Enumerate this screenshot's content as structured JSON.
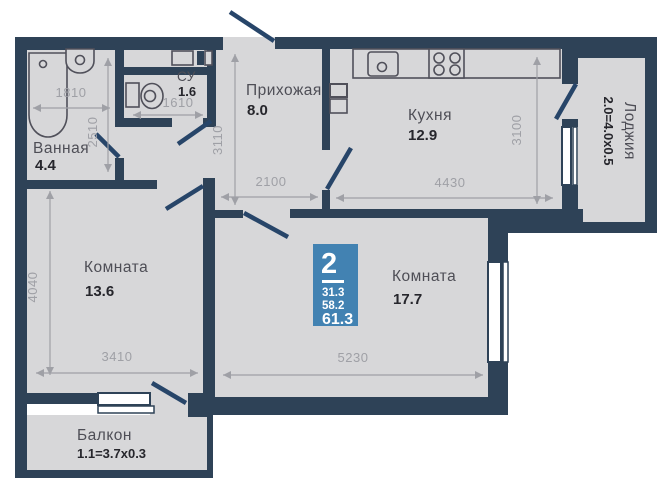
{
  "plan": {
    "badge": {
      "rooms": "2",
      "area_living": "31.3",
      "area_mid": "58.2",
      "area_total": "61.3"
    },
    "rooms": {
      "bathroom": {
        "name": "Ванная",
        "area": "4.4"
      },
      "wc": {
        "name": "СУ",
        "area": "1.6"
      },
      "hall": {
        "name": "Прихожая",
        "area": "8.0"
      },
      "kitchen": {
        "name": "Кухня",
        "area": "12.9"
      },
      "room1": {
        "name": "Комната",
        "area": "13.6"
      },
      "room2": {
        "name": "Комната",
        "area": "17.7"
      },
      "balcony": {
        "name": "Балкон",
        "area": "1.1=3.7x0.3"
      },
      "loggia": {
        "name": "Лоджия",
        "area": "2.0=4.0x0.5"
      }
    },
    "dimensions": {
      "bath_w": "1810",
      "bath_h": "2510",
      "wc_w": "1610",
      "hall_h": "3110",
      "hall_w": "2100",
      "kitchen_w": "4430",
      "kitchen_h": "3100",
      "room1_h": "4040",
      "room1_w": "3410",
      "room2_w": "5230"
    },
    "colors": {
      "wall": "#2e4257",
      "leaf": "#274569",
      "room_fill": "#d7d7d9",
      "dim": "#9fa0a6",
      "badge": "#4282b2",
      "fixture": "#50505a"
    }
  }
}
